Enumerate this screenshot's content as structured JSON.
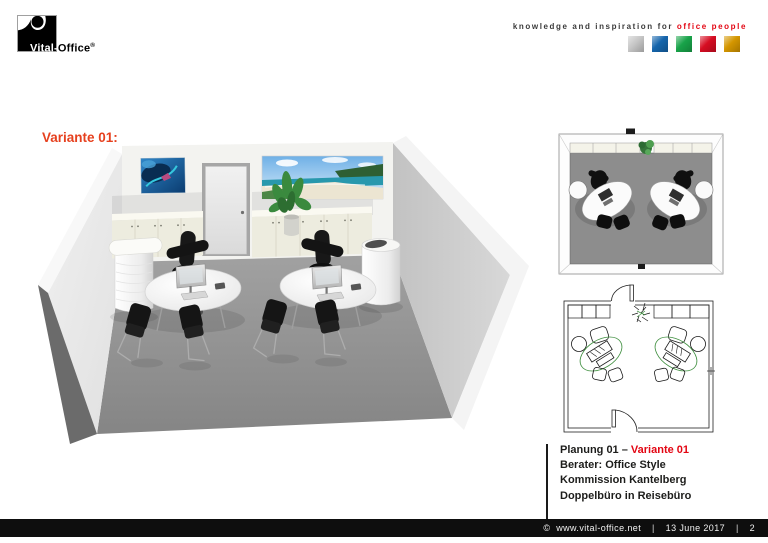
{
  "header": {
    "logo": {
      "text_prefix": "Vital-",
      "text_suffix": "Office",
      "registered_mark": "®"
    },
    "tagline": {
      "prefix": "knowledge and inspiration for ",
      "highlight": "office people",
      "highlight_color": "#e30613"
    },
    "color_squares": [
      {
        "name": "silver",
        "color": "#c6c6c6"
      },
      {
        "name": "blue",
        "color": "#1565ac"
      },
      {
        "name": "green",
        "color": "#18a349"
      },
      {
        "name": "red",
        "color": "#d60d22"
      },
      {
        "name": "gold",
        "color": "#d49600"
      }
    ]
  },
  "main": {
    "variant_heading": "Variante 01:",
    "variant_heading_color": "#e6401e",
    "figures": {
      "perspective_render": "3d-room-perspective-render",
      "top_view": "3d-room-top-view-render",
      "floor_plan": "floor-plan-line-drawing"
    }
  },
  "details": {
    "line1_prefix": "Planung 01 – ",
    "line1_highlight": "Variante 01",
    "line2": "Berater: Office Style",
    "line3": "Kommission Kantelberg",
    "line4": "Doppelbüro in Reisebüro"
  },
  "footer": {
    "copyright": "©",
    "website": "www.vital-office.net",
    "separator": "|",
    "date": "13 June 2017",
    "page_number": "2"
  }
}
